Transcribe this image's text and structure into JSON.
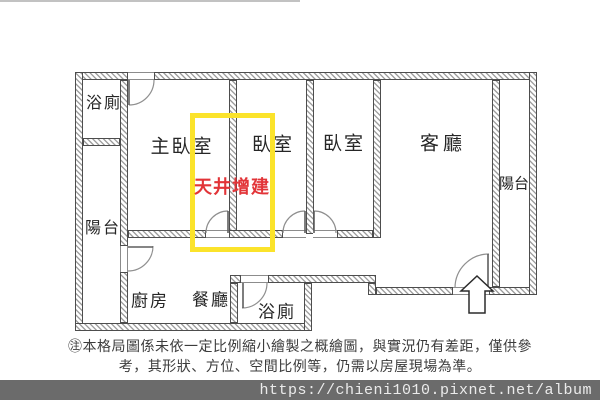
{
  "floorplan": {
    "rooms": [
      {
        "id": "bath-top-left",
        "label": "浴廁"
      },
      {
        "id": "master-bedroom",
        "label": "主臥室"
      },
      {
        "id": "bedroom-1",
        "label": "臥室"
      },
      {
        "id": "bedroom-2",
        "label": "臥室"
      },
      {
        "id": "living-room",
        "label": "客廳"
      },
      {
        "id": "balcony-right",
        "label": "陽台"
      },
      {
        "id": "balcony-left",
        "label": "陽台"
      },
      {
        "id": "kitchen",
        "label": "廚房"
      },
      {
        "id": "dining-room",
        "label": "餐廳"
      },
      {
        "id": "bath-bottom",
        "label": "浴廁"
      }
    ],
    "annotation": {
      "label": "天井增建",
      "text_color": "#e23438",
      "highlight_box_color": "#fbe32b"
    },
    "entrance_marker": "up-arrow"
  },
  "disclaimer": {
    "line1": "㊟本格局圖係未依一定比例縮小繪製之概繪圖，與實況仍有差距，僅供參",
    "line2": "考，其形狀、方位、空間比例等，仍需以房屋現場為準。"
  },
  "watermark": {
    "url": "https://chieni1010.pixnet.net/album",
    "bar_color": "#6b6b6b"
  }
}
